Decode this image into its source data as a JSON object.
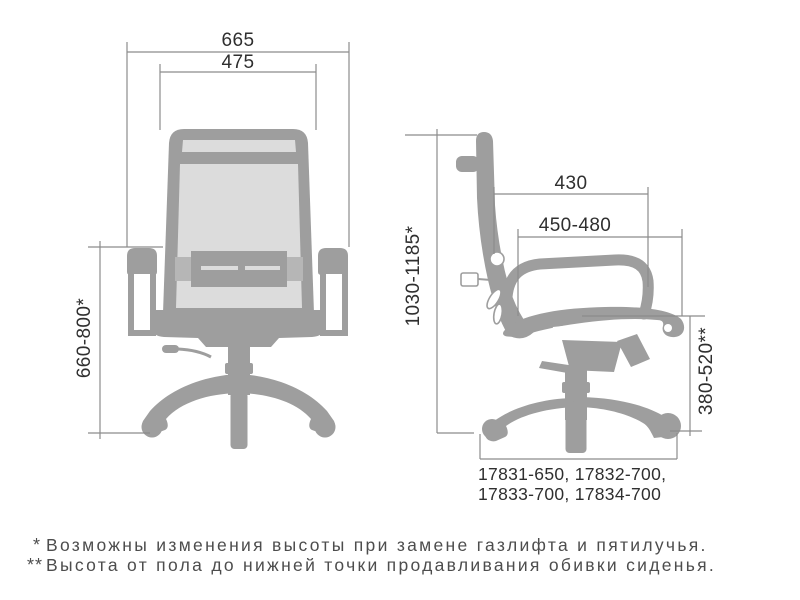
{
  "colors": {
    "bg": "#ffffff",
    "chair": "#9e9e9e",
    "mesh": "#dcdcdc",
    "lumbar_side": "#b6b6b6",
    "dim_line": "#8c8c8c",
    "dim_text": "#2f2f2f",
    "note_text": "#4d4d4d"
  },
  "front_view": {
    "overall_width_label": "665",
    "backrest_width_label": "475",
    "height_range_label": "660-800*"
  },
  "side_view": {
    "overall_height_label": "1030-1185*",
    "backrest_depth_label": "430",
    "seat_depth_label": "450-480",
    "seat_height_label": "380-520**",
    "base_models_line1": "17831-650, 17832-700,",
    "base_models_line2": "17833-700, 17834-700"
  },
  "footnotes": [
    {
      "marker": "*",
      "text": "Возможны изменения высоты при замене газлифта и пятилучья."
    },
    {
      "marker": "**",
      "text": "Высота от пола до нижней точки продавливания обивки сиденья."
    }
  ]
}
